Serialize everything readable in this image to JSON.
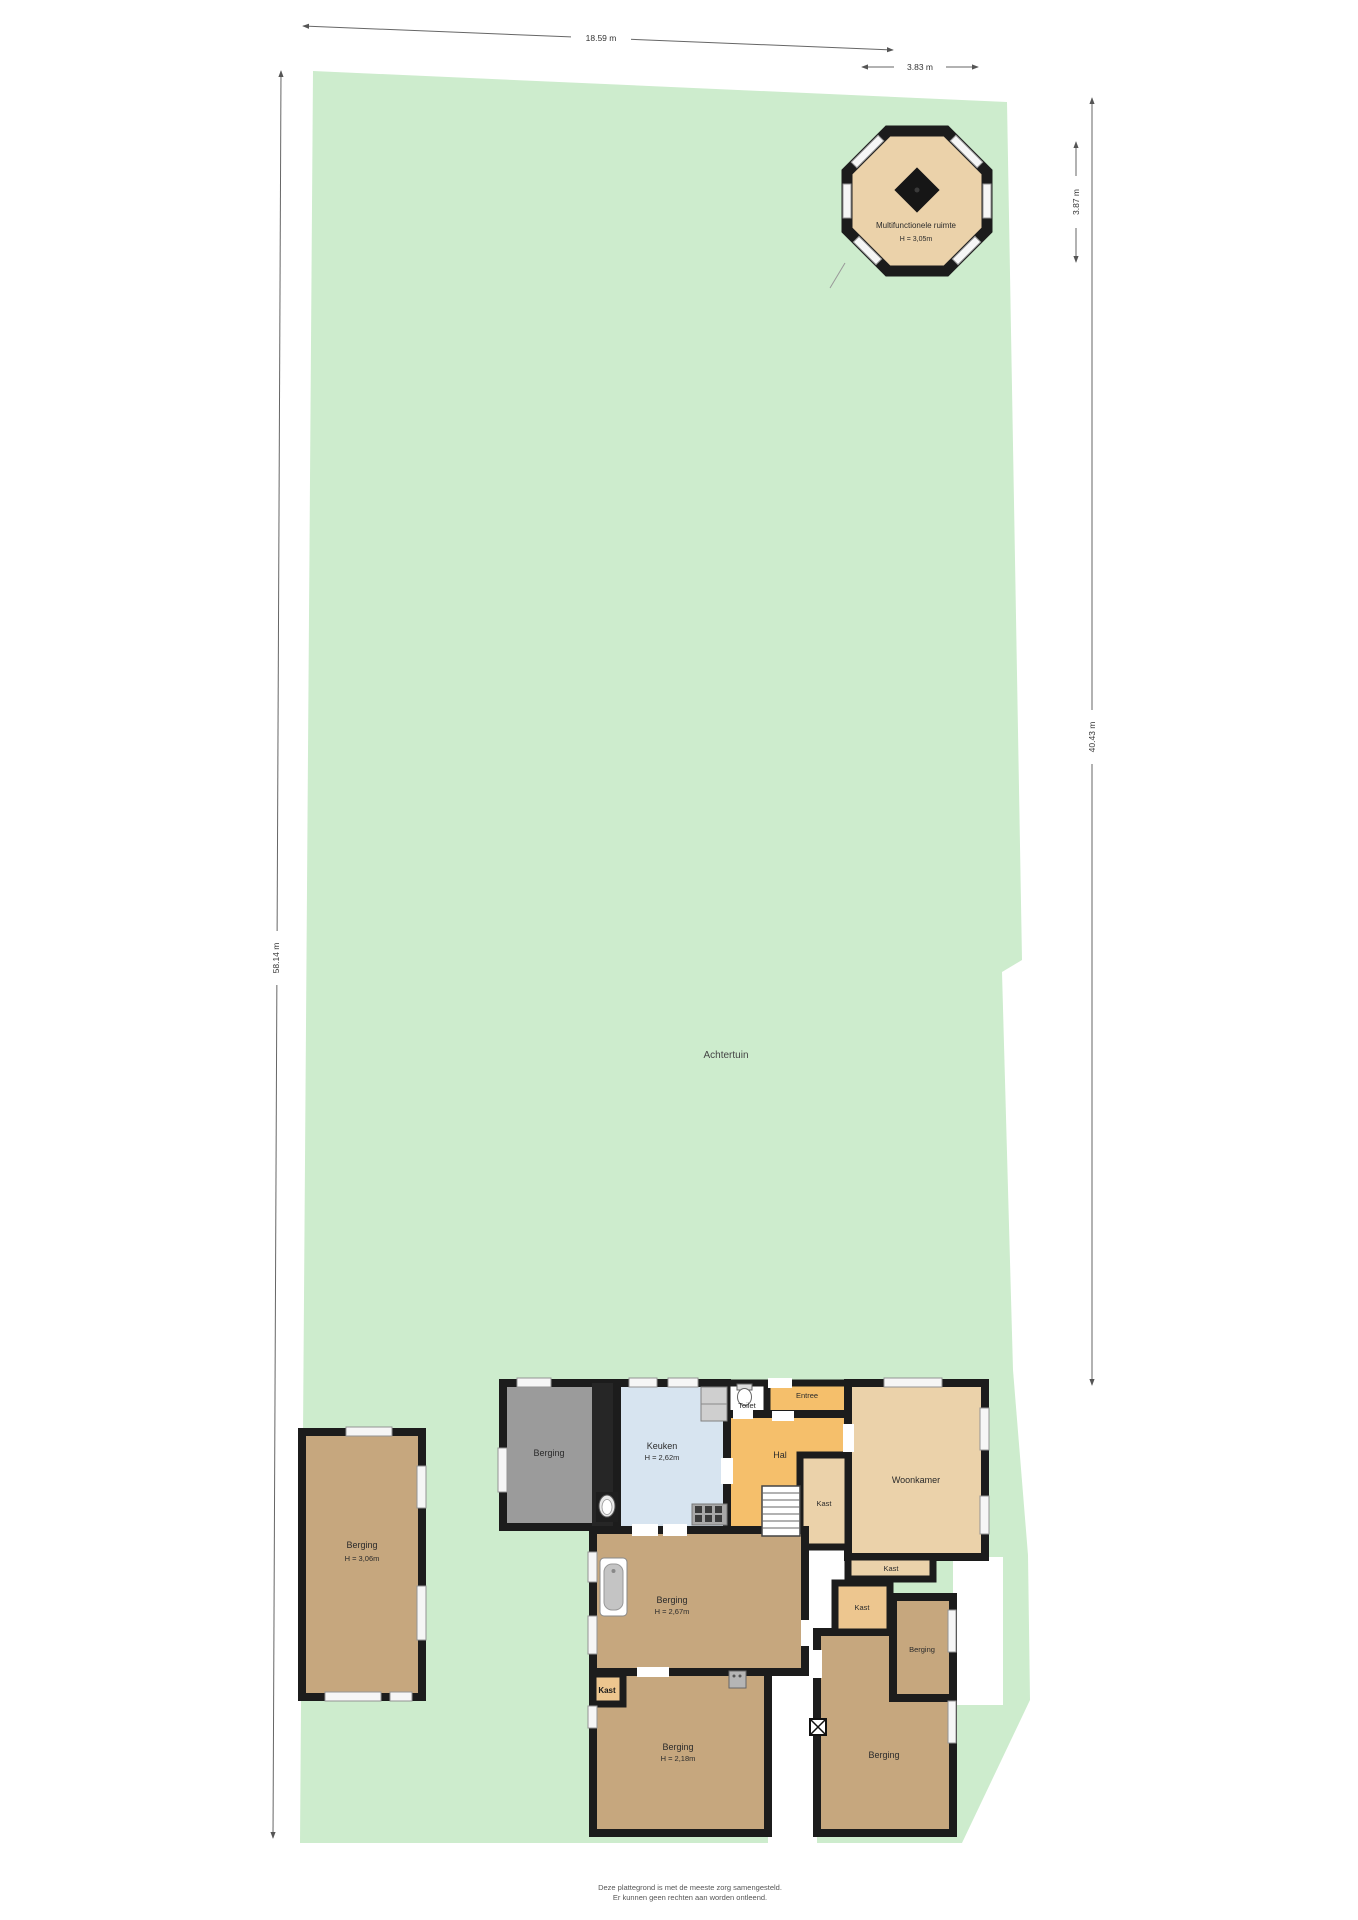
{
  "colors": {
    "plot_green": "#cdeccd",
    "floor_tan": "#c6a77e",
    "floor_beige": "#ebd2aa",
    "floor_orange": "#f5bf6b",
    "floor_blue": "#d7e4f0",
    "floor_gray": "#9b9b9b",
    "kast_orange": "#edc68f",
    "wall_black": "#1c1c1c"
  },
  "dimensions": {
    "top_width": "18.59 m",
    "octagon_width": "3.83 m",
    "octagon_height": "3.87 m",
    "plot_right_height": "40.43 m",
    "plot_left_height": "58.14 m"
  },
  "garden": {
    "label": "Achtertuin"
  },
  "octagon": {
    "name": "Multifunctionele ruimte",
    "height": "H = 3,05m"
  },
  "outbuilding": {
    "name": "Berging",
    "height": "H = 3,06m"
  },
  "rooms": {
    "berging_annex": {
      "name": "Berging"
    },
    "keuken": {
      "name": "Keuken",
      "height": "H = 2,62m"
    },
    "toilet": {
      "name": "Toilet"
    },
    "entree": {
      "name": "Entree"
    },
    "hal": {
      "name": "Hal"
    },
    "kast_stairs": {
      "name": "Kast"
    },
    "woonkamer": {
      "name": "Woonkamer"
    },
    "berging_mid": {
      "name": "Berging",
      "height": "H = 2,67m"
    },
    "kast_strip": {
      "name": "Kast"
    },
    "kast_small": {
      "name": "Kast"
    },
    "berging_right": {
      "name": "Berging"
    },
    "kast_bottom": {
      "name": "Kast"
    },
    "berging_bottom_left": {
      "name": "Berging",
      "height": "H = 2,18m"
    },
    "berging_bottom_right": {
      "name": "Berging"
    }
  },
  "footer": {
    "line1": "Deze plattegrond is met de meeste zorg samengesteld.",
    "line2": "Er kunnen geen rechten aan worden ontleend."
  }
}
